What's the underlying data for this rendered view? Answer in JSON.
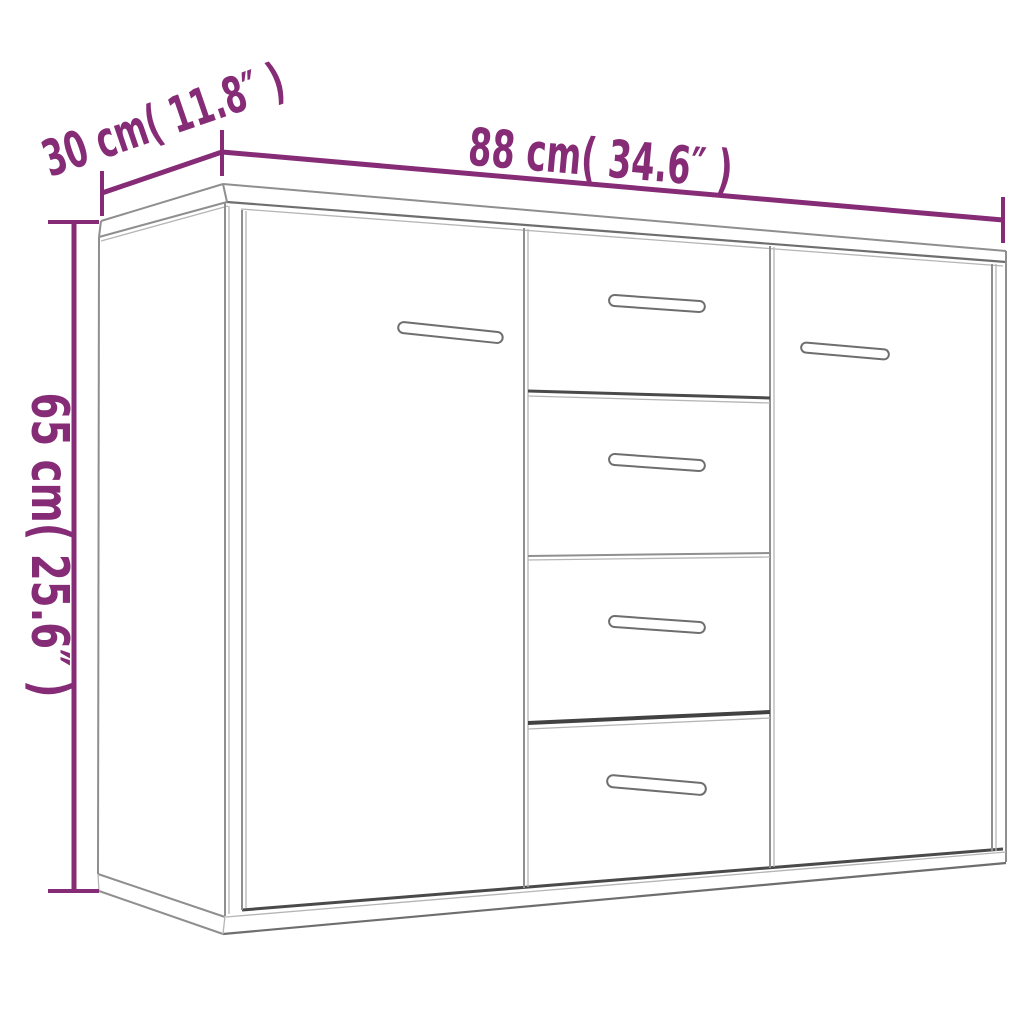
{
  "dimensions": {
    "width_label": "88 cm( 34.6″ )",
    "depth_label": "30 cm( 11.8″ )",
    "height_label": "65 cm( 25.6″ )"
  },
  "colors": {
    "accent": "#862c77",
    "line-light": "#8f8f8f",
    "line-lighter": "#b5b5b5",
    "line-mid": "#6e6e6e",
    "line-dark": "#4a4a4a",
    "background": "#ffffff"
  }
}
